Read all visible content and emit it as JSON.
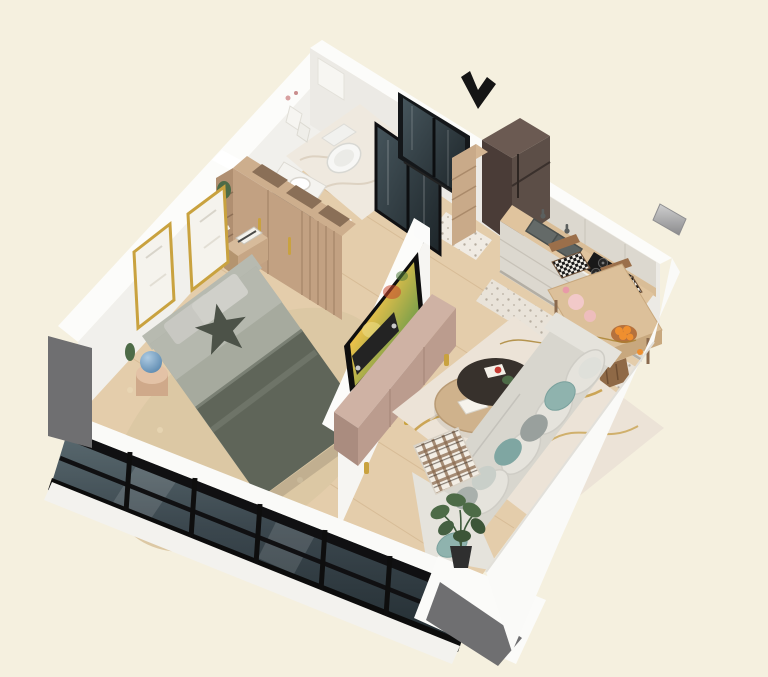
{
  "scene": {
    "type": "3d-isometric-apartment-floor-plan-render",
    "entrance_marker": "black arrow pointing at entry door",
    "rooms": [
      {
        "name": "bathroom",
        "items": [
          "toilet",
          "navy vanity with white sink",
          "wall towels",
          "dark glass shower"
        ]
      },
      {
        "name": "entrance-hall",
        "items": [
          "dark glass entry door",
          "wood shelf column",
          "white runner rug"
        ]
      },
      {
        "name": "kitchen",
        "items": [
          "dark two-door fridge",
          "cream upper cabinets",
          "wood countertop",
          "double sink",
          "gas hob",
          "cream base cabinets",
          "patterned tile strip"
        ]
      },
      {
        "name": "dining-area",
        "items": [
          "wood dining table",
          "checkered-cushion chairs",
          "wood chairs",
          "bowl of oranges",
          "pink plates"
        ]
      },
      {
        "name": "bedroom",
        "items": [
          "double bed with olive blanket",
          "star-shaped pillow",
          "two gold picture frames",
          "wood wardrobe with open cubbies",
          "nightstand with books",
          "side table with blue globe",
          "cactus",
          "beige shag rug",
          "floor-to-ceiling glazing"
        ]
      },
      {
        "name": "living-room",
        "items": [
          "white divider wall with mounted TV",
          "soundbar",
          "tan media console with gold legs",
          "two-tier round coffee table",
          "white rug with gold marbling",
          "L-shaped light sofa",
          "teal and gray cushions",
          "plaid blanket",
          "potted plant",
          "black floor lamp"
        ]
      }
    ]
  },
  "palette": {
    "bg": "#f5f0df",
    "wall_white": "#fcfcfa",
    "wall_inner_nw": "#f1f0ec",
    "wall_inner_ne": "#eceae5",
    "wall_divider": "#f6f5f2",
    "gray_pillar": "#6f6f71",
    "glass_dark": "#36424a",
    "glass_light": "#5a6a70",
    "frame_black": "#101012",
    "floor_wood": "#e4cdab",
    "plank_line": "#d2b58f",
    "bath_floor": "#efe9df",
    "kitchen_tile": "#e9e3d9",
    "shag_rug": "#dcc8a4",
    "wardrobe_wood": "#c2a182",
    "wardrobe_top": "#cdae8d",
    "bed_sheet": "#a6aa9e",
    "bed_blanket": "#5f6559",
    "pillow_light": "#c8c8c2",
    "star_pillow": "#4c5248",
    "gold_accent": "#c9a23f",
    "console_top": "#cfb2a4",
    "console_front": "#bb9c8e",
    "sofa": "#d8d6ce",
    "sofa_light": "#e5e3dc",
    "pillow_teal": "#8fb3ae",
    "rug_base": "#ece3d7",
    "rug_gold": "#c59a3f",
    "coffee_dark": "#37312c",
    "coffee_wood": "#cfb28c",
    "counter_wood": "#e0c49e",
    "cabinet_cream": "#dcd8cf",
    "fridge_front": "#4a3c37",
    "fridge_side": "#5c4e47",
    "stove_black": "#191919",
    "vanity_navy": "#46525e",
    "plant_green": "#4d6b47",
    "orange_fruit": "#ef8f2f",
    "arrow_black": "#151515"
  }
}
